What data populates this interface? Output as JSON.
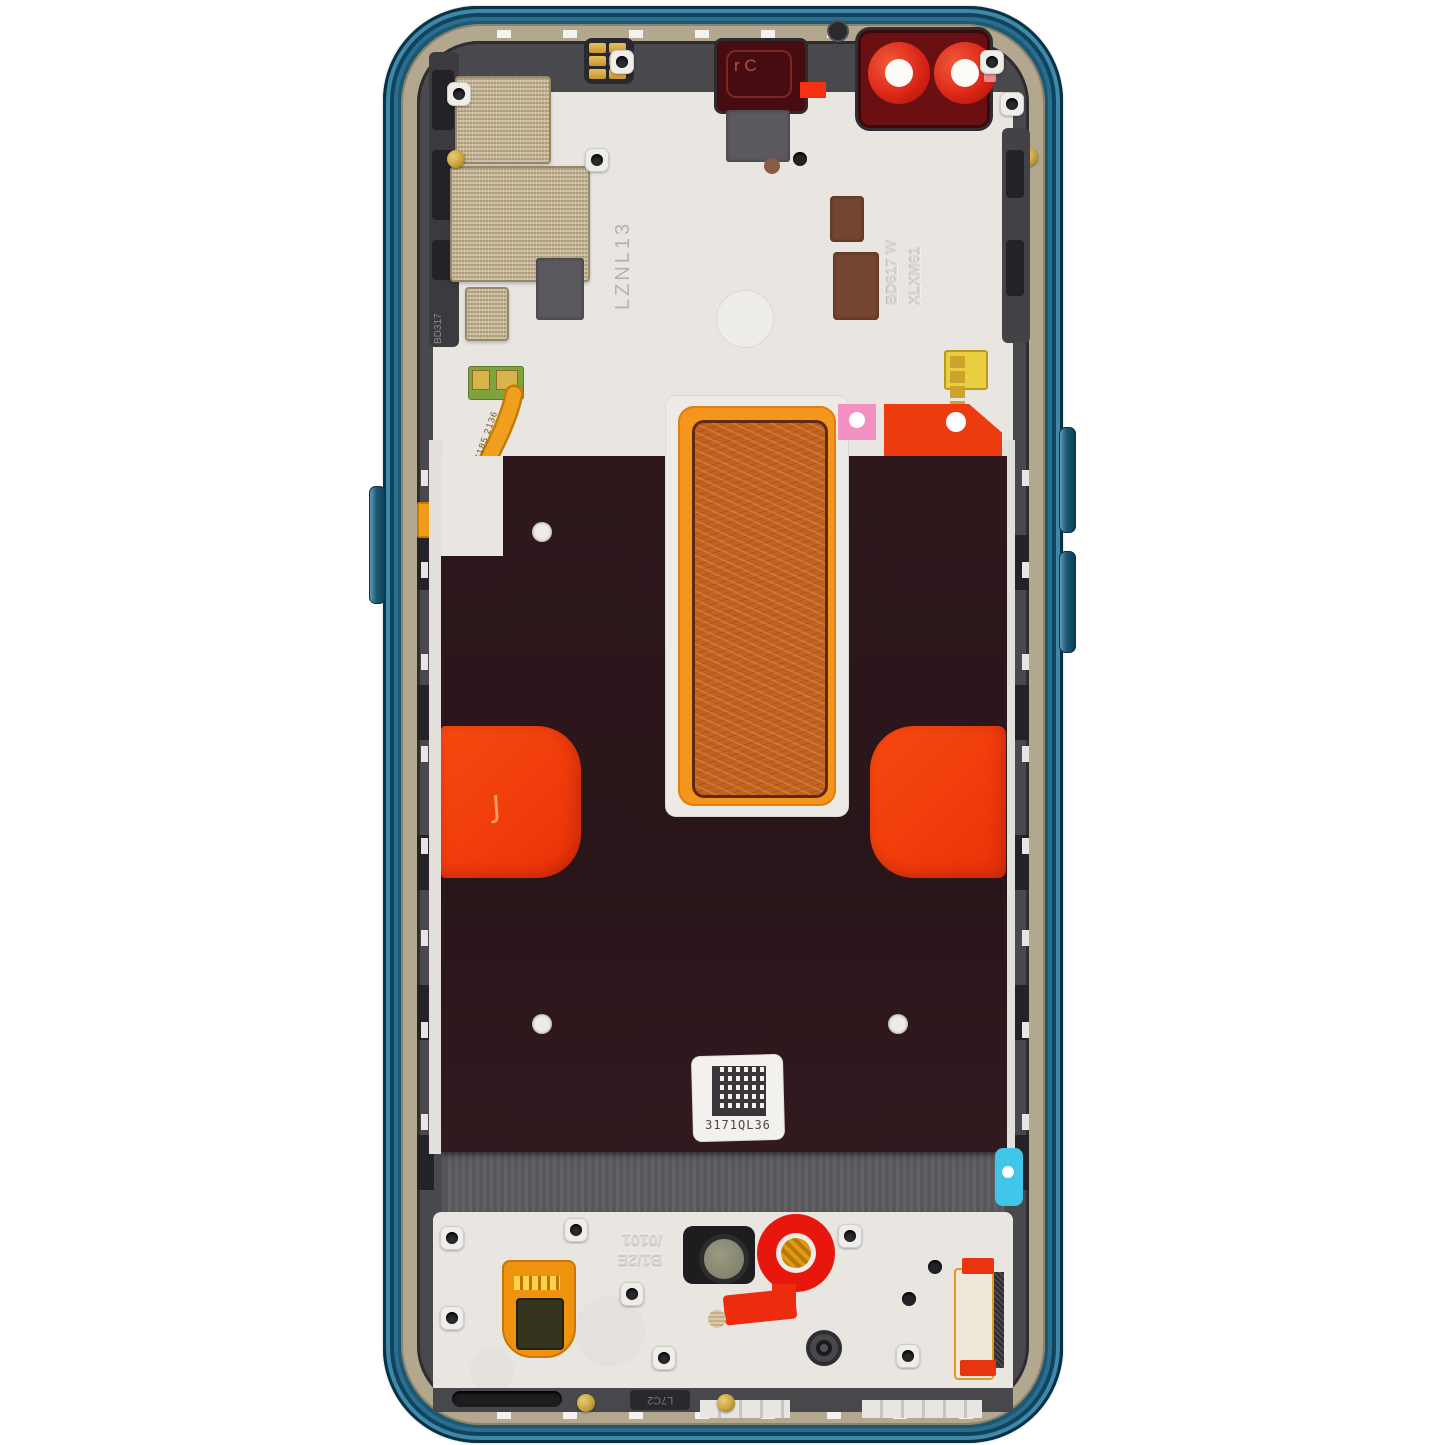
{
  "scene": {
    "description": "Top-down product photograph of a smartphone display assembly mid-frame (rear view): teal blue metal frame, white plastic chassis, dark maroon display back with orange thermal foil strip, red adhesive pulls, dual red camera lens bezel and service barcode label",
    "background_color": "#ffffff"
  },
  "frame_colors": {
    "outer_teal": "#1b5873",
    "metal_rail": "#b3a78f",
    "inner_chassis": "#49484d",
    "plastic": "#e9e6e2"
  },
  "display_back": {
    "panel_color": "#2c171b",
    "thermal_foil_border": "#f6951d",
    "thermal_foil_copper": "#c4611d",
    "adhesive_red": "#ee3a0f",
    "adhesive_pink": "#f291c2",
    "pull_tab_cyan": "#41c5e8",
    "adhesive_letter": "J"
  },
  "camera": {
    "bezel_color": "#6a0f12",
    "ring_color": "#e03222",
    "lens_count": 2
  },
  "labels": {
    "barcode_text": "3171QL36",
    "flex_cable_code": "FB0319-0 C185 2136",
    "panel_code": "LZNL13",
    "embossed_right_1": "BD617 W",
    "embossed_right_2": "XLXM61",
    "embossed_left": "BD317",
    "embossed_bottom_1": "B1/2E",
    "embossed_bottom_2": "/0101",
    "bottom_rail_code": "L7C2",
    "flash_window_mark": "r C"
  }
}
